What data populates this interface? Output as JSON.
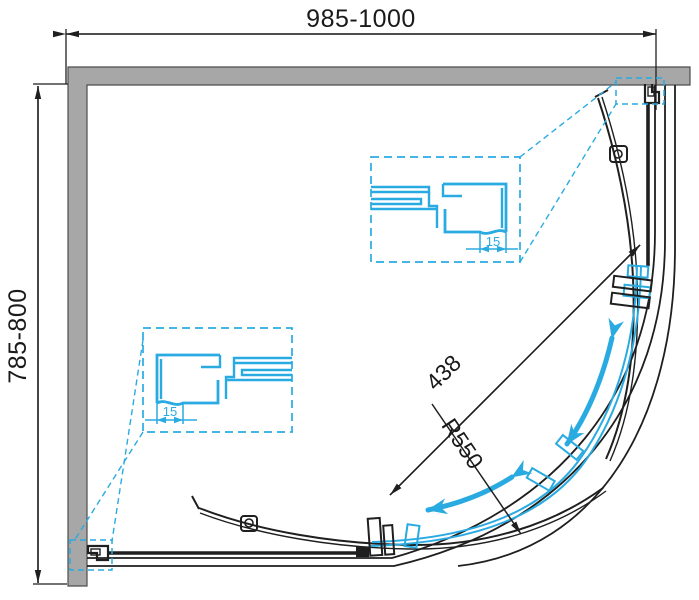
{
  "drawing": {
    "kind": "shower-enclosure-plan",
    "dimensions": {
      "overall_width": "985-1000",
      "overall_depth": "785-800",
      "door_opening": "438",
      "curve_radius": "R550",
      "profile_adjust_top_detail": "15",
      "profile_adjust_bottom_detail": "15"
    },
    "colors": {
      "accent_cyan": "#29abe2",
      "wall_gray": "#a7a7a7",
      "line_black": "#1f1f1f"
    }
  }
}
